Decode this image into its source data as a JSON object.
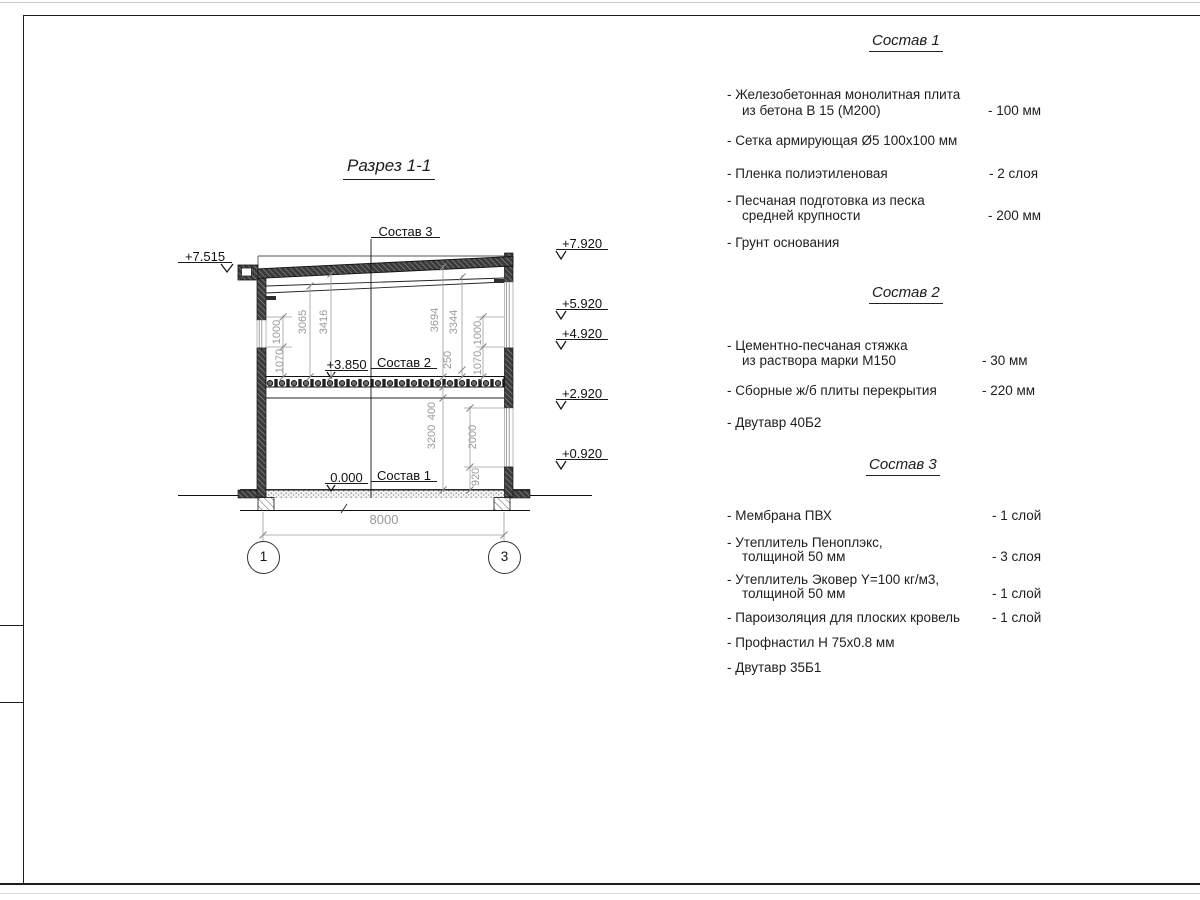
{
  "drawing": {
    "title": "Разрез 1-1",
    "leader1": "Состав 1",
    "leader2": "Состав 2",
    "leader3": "Состав 3",
    "elev_eaves": "+7.515",
    "elev_roof": "+7.920",
    "elev_5": "+5.920",
    "elev_4": "+4.920",
    "elev_2": "+2.920",
    "elev_0": "+0.920",
    "elev_floor2": "+3.850",
    "elev_floor1": "0.000",
    "axis_left": "1",
    "axis_right": "3",
    "dim_span": "8000",
    "dim_1000_left": "1000",
    "dim_1070_left": "1070",
    "dim_3065": "3065",
    "dim_3416": "3416",
    "dim_3694": "3694",
    "dim_3344": "3344",
    "dim_250": "250",
    "dim_400": "400",
    "dim_3200": "3200",
    "dim_2000": "2000",
    "dim_920": "920",
    "dim_1000_right": "1000",
    "dim_1070_right": "1070"
  },
  "specs": [
    {
      "title": "Состав 1",
      "items": [
        {
          "line1": "- Железобетонная  монолитная плита",
          "line2": "из бетона В 15 (М200)",
          "value": "- 100 мм"
        },
        {
          "line1": "- Сетка армирующая Ø5 100х100 мм"
        },
        {
          "line1": "- Пленка полиэтиленовая",
          "value": "- 2 слоя"
        },
        {
          "line1": "- Песчаная подготовка из песка",
          "line2": "средней крупности",
          "value": "- 200 мм"
        },
        {
          "line1": "- Грунт основания"
        }
      ]
    },
    {
      "title": "Состав 2",
      "items": [
        {
          "line1": "- Цементно-песчаная стяжка",
          "line2": "из раствора марки М150",
          "value": "- 30 мм"
        },
        {
          "line1": "- Сборные ж/б плиты перекрытия",
          "value": "- 220 мм"
        },
        {
          "line1": "- Двутавр 40Б2"
        }
      ]
    },
    {
      "title": "Состав 3",
      "items": [
        {
          "line1": "- Мембрана ПВХ",
          "value": "- 1 слой"
        },
        {
          "line1": "- Утеплитель Пеноплэкс,",
          "line2": "толщиной 50 мм",
          "value": "- 3 слоя"
        },
        {
          "line1": "- Утеплитель Эковер Y=100 кг/м3,",
          "line2": "толщиной 50 мм",
          "value": "- 1 слой"
        },
        {
          "line1": "- Пароизоляция для плоских кровель",
          "value": "- 1 слой"
        },
        {
          "line1": "- Профнастил Н 75х0.8 мм"
        },
        {
          "line1": "- Двутавр 35Б1"
        }
      ]
    }
  ]
}
